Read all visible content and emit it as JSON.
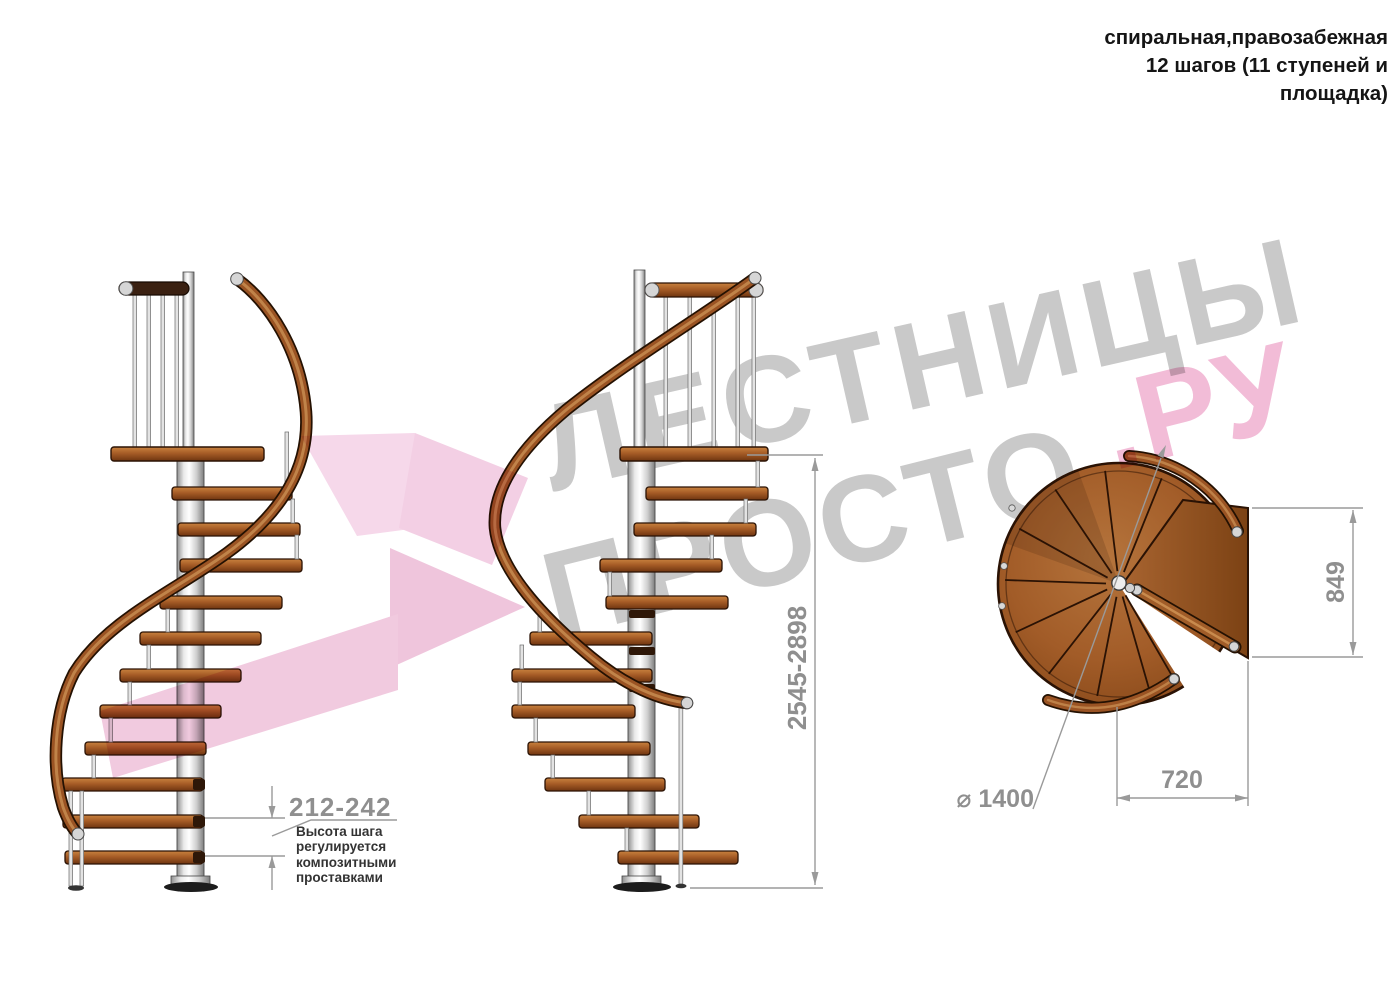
{
  "title": {
    "lines": [
      "спиральная,правозабежная",
      "12 шагов (11 ступеней и",
      "площадка)"
    ]
  },
  "watermark": {
    "word1": "ЛЕСТНИЦЫ",
    "word2": "ПРОСТО",
    "word3": ".РУ",
    "gray_color": "#c9c9c9",
    "pink_color": "#f2bcd7"
  },
  "dimensions": {
    "step_height": "212-242",
    "step_height_note_lines": [
      "Высота шага",
      "регулируется",
      "композитными",
      "проставками"
    ],
    "total_height": "2545-2898",
    "landing_width": "849",
    "tread_width": "720",
    "diameter": "⌀ 1400"
  },
  "colors": {
    "wood": "#a05a26",
    "wood_outline": "#2a1204",
    "metal": "#d9d9d9",
    "dimension_gray": "#9a9a9a",
    "pink_arrow": "#f1cadf"
  }
}
